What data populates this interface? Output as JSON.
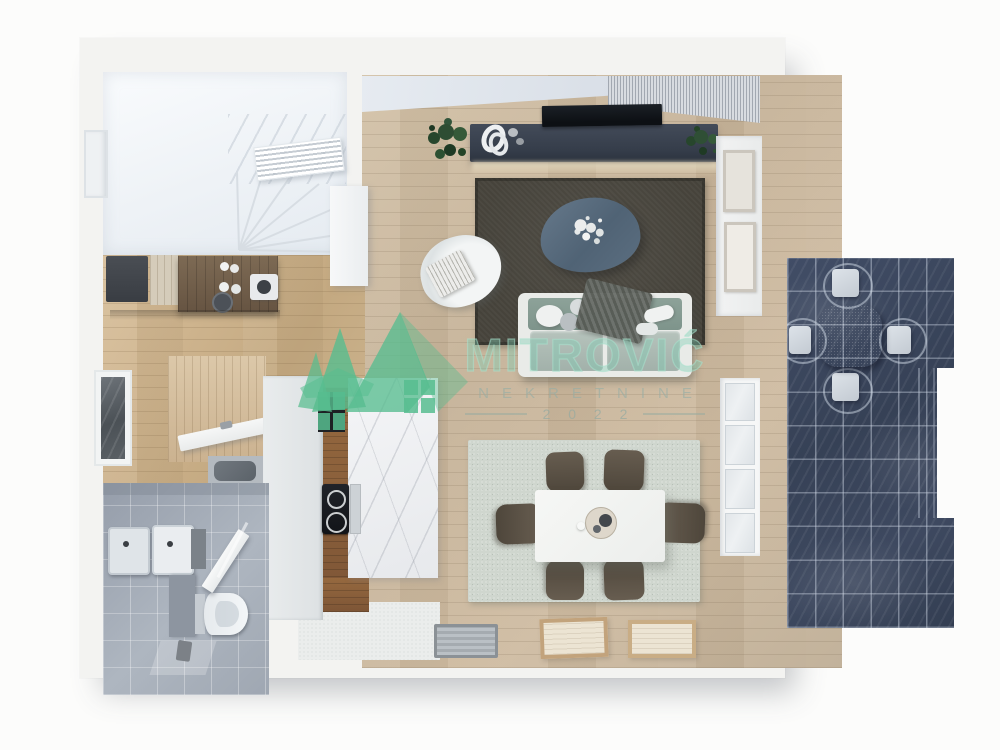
{
  "watermark": {
    "brand": "MITROVIĆ",
    "subtitle": "NEKRETNINE",
    "year": "2 0 2 2",
    "accent_color": "#57bd8f"
  },
  "palette": {
    "wall": "#f3f3f1",
    "wood_floor": "#c9b69c",
    "kitchen_wood": "#cdb28f",
    "stair_floor": "#eef2f6",
    "bathroom_tile": "#a4acb6",
    "terrace_tile": "#3b465c",
    "living_rug": "#46433b",
    "dining_rug": "#cfd6ce",
    "sofa": "#a2b1aa",
    "tv_console": "#3a4250",
    "tv_screen": "#0d1014",
    "coffee_table": "#56697b",
    "marble_island": "#eef0f2",
    "island_wood": "#8a5f3e",
    "dining_chair": "#564e42",
    "dining_table": "#f4f5f3",
    "outdoor_table": "#57616e",
    "outdoor_chair": "#d3d9de"
  }
}
